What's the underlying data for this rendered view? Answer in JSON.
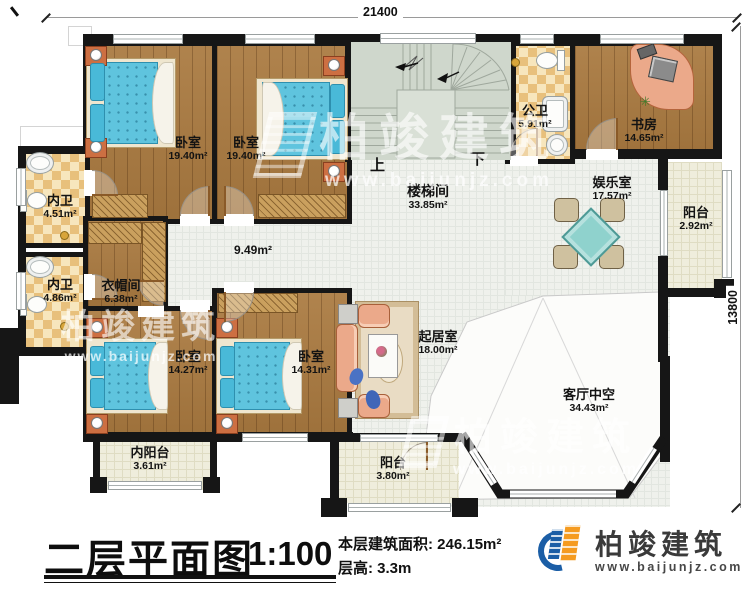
{
  "dimensions": {
    "top": "21400",
    "right": "13800"
  },
  "rooms": {
    "bedroom_tl": {
      "name": "卧室",
      "area": "19.40m²"
    },
    "bedroom_tm": {
      "name": "卧室",
      "area": "19.40m²"
    },
    "stairwell": {
      "name": "楼梯间",
      "area": "33.85m²"
    },
    "public_bath": {
      "name": "公卫",
      "area": "5.91m²"
    },
    "study": {
      "name": "书房",
      "area": "14.65m²"
    },
    "entertainment": {
      "name": "娱乐室",
      "area": "17.57m²"
    },
    "balcony_right": {
      "name": "阳台",
      "area": "2.92m²"
    },
    "bath_top": {
      "name": "内卫",
      "area": "4.51m²"
    },
    "bath_bottom": {
      "name": "内卫",
      "area": "4.86m²"
    },
    "cloakroom": {
      "name": "衣帽间",
      "area": "6.38m²"
    },
    "hallway": {
      "area": "9.49m²"
    },
    "bedroom_bl": {
      "name": "卧室",
      "area": "14.27m²"
    },
    "bedroom_bm": {
      "name": "卧室",
      "area": "14.31m²"
    },
    "inner_balcony": {
      "name": "内阳台",
      "area": "3.61m²"
    },
    "living": {
      "name": "起居室",
      "area": "18.00m²"
    },
    "void": {
      "name": "客厅中空",
      "area": "34.43m²"
    },
    "balcony_bottom": {
      "name": "阳台",
      "area": "3.80m²"
    }
  },
  "stairs": {
    "up": "上",
    "down": "下"
  },
  "titleblock": {
    "title": "二层平面图",
    "scale": "1:100",
    "area_label": "本层建筑面积:",
    "area_value": "246.15m²",
    "floor_height_label": "层高:",
    "floor_height_value": "3.3m"
  },
  "brand": {
    "name": "柏竣建筑",
    "url": "www.baijunjz.com"
  },
  "watermark": {
    "name": "柏竣建筑",
    "url": "www.baijunjz.com"
  },
  "colors": {
    "wall": "#161616",
    "wood": "#aa7a40",
    "tile": "#f1d9a6",
    "stair_floor": "#cfd7cc",
    "grid_floor": "#eff1ec",
    "balcony_floor": "#efeddc",
    "bed": "#5fc4de",
    "sofa": "#eba98a",
    "table": "#8fd2cd",
    "brand_blue": "#1b5ea6",
    "brand_orange": "#f59b20"
  }
}
